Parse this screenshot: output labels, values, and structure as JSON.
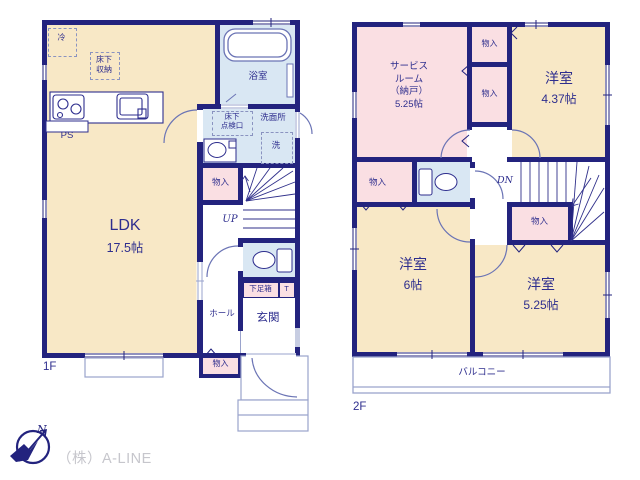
{
  "colors": {
    "wall": "#23237E",
    "room_beige": "#F8E8C6",
    "room_pink": "#FADFE3",
    "room_blue": "#D9E7F3",
    "fixture_line": "#6B74B5",
    "thin_line": "#9AA3CC",
    "text": "#2E2E8E",
    "company_gray": "#C6C6CC"
  },
  "floor1": {
    "label": "1F",
    "ldk": {
      "name": "LDK",
      "size": "17.5帖"
    },
    "bathroom": "浴室",
    "washroom": "洗面所",
    "laundry": "洗",
    "underfloor_hatch": "床下\n点検口",
    "underfloor_storage": "床下\n収納",
    "refrigerator": "冷",
    "pipe_space": "PS",
    "closet_mid": "物入",
    "closet_south": "物入",
    "stairs_up": "UP",
    "shoe_box": "下足箱",
    "shoe_t": "T",
    "hall": "ホール",
    "entrance": "玄関"
  },
  "floor2": {
    "label": "2F",
    "service_room": "サービス\nルーム\n（納戸）\n5.25帖",
    "room_ne": {
      "name": "洋室",
      "size": "4.37帖"
    },
    "room_sw": {
      "name": "洋室",
      "size": "6帖"
    },
    "room_se": {
      "name": "洋室",
      "size": "5.25帖"
    },
    "closet_a": "物入",
    "closet_b": "物入",
    "closet_c": "物入",
    "closet_d": "物入",
    "stairs_down": "DN",
    "balcony": "バルコニー"
  },
  "footer": {
    "company": "（株）A-LINE",
    "compass_north": "N"
  }
}
